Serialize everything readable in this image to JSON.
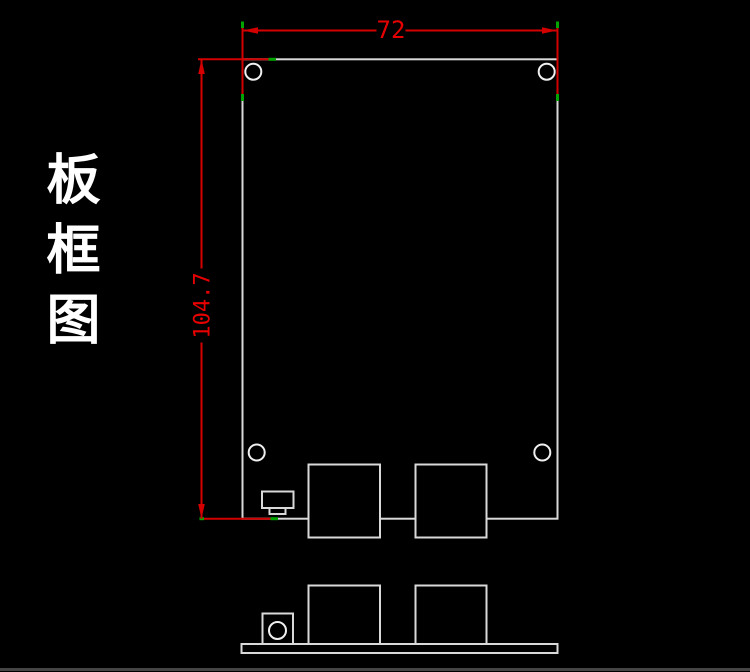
{
  "title": {
    "text": "板框图"
  },
  "dimensions": {
    "width": {
      "label": "72"
    },
    "height": {
      "label": "104.7"
    }
  },
  "colors": {
    "background": "#000000",
    "board_outline": "#d9d9d9",
    "hole_outline": "#f0f0f0",
    "dimension_red": "#d40000",
    "dimension_text": "#e60000",
    "snap_tick_green": "#00a400",
    "title_white": "#ffffff",
    "bottom_divider": "#454545"
  }
}
